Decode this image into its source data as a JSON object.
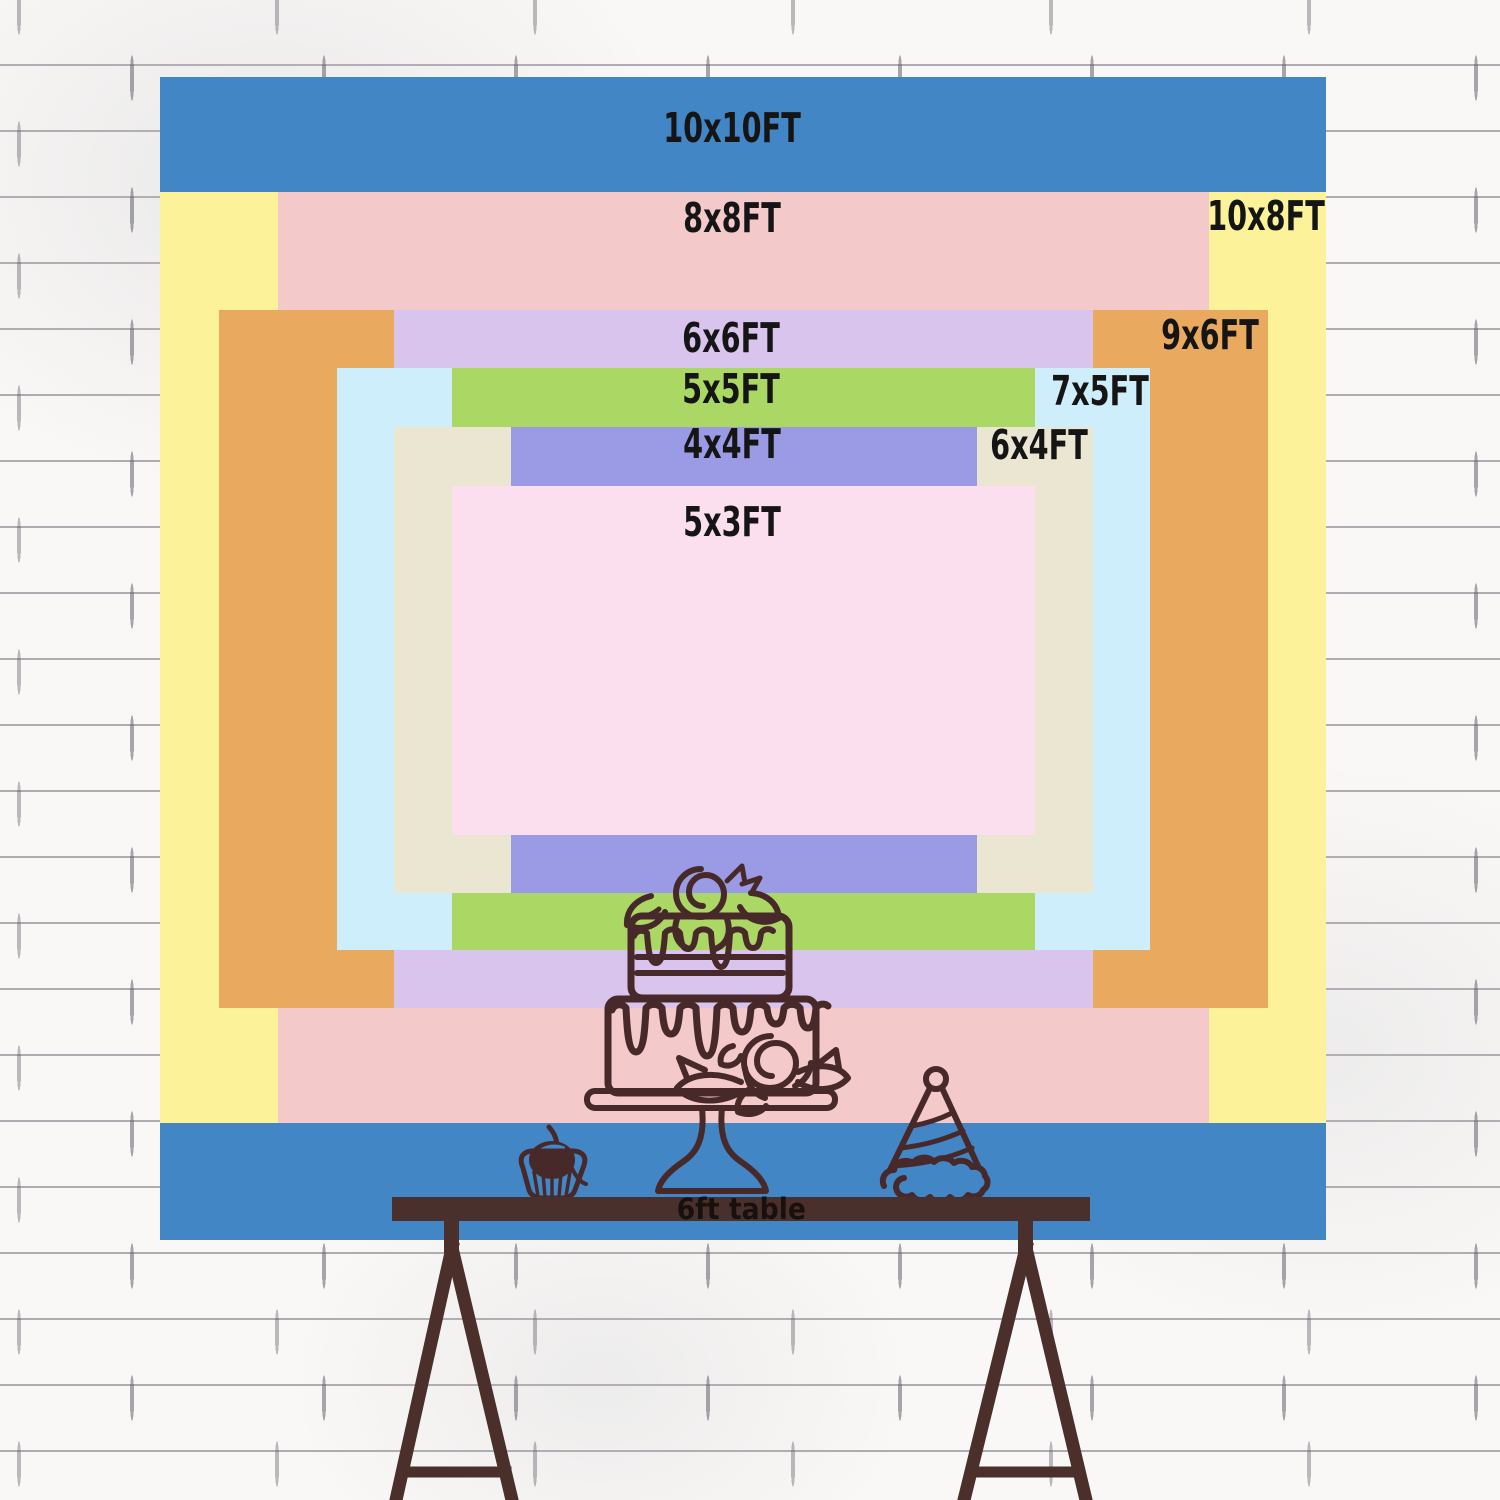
{
  "backdrop": {
    "title": "backdrop size comparison chart",
    "wall": {
      "background": "#f9f8f6",
      "mortar_line": "#64606a"
    },
    "label_text_color": "#151515",
    "illustration_stroke_color": "#48292a",
    "sizes": [
      {
        "label": "10x10FT",
        "width_ft": 10,
        "height_ft": 10,
        "x": 160,
        "y": 77,
        "w": 1166,
        "h": 1163,
        "color": "#4286c6",
        "label_x": 732,
        "label_y": 128
      },
      {
        "label": "10x8FT",
        "width_ft": 10,
        "height_ft": 8,
        "x": 160,
        "y": 192,
        "w": 1166,
        "h": 931,
        "color": "#fbf29a",
        "label_x": 1266,
        "label_y": 216
      },
      {
        "label": "8x8FT",
        "width_ft": 8,
        "height_ft": 8,
        "x": 278,
        "y": 192,
        "w": 931,
        "h": 931,
        "color": "#f3c9ca",
        "label_x": 732,
        "label_y": 218
      },
      {
        "label": "9x6FT",
        "width_ft": 9,
        "height_ft": 6,
        "x": 219,
        "y": 310,
        "w": 1049,
        "h": 698,
        "color": "#e9a95e",
        "label_x": 1210,
        "label_y": 335
      },
      {
        "label": "6x6FT",
        "width_ft": 6,
        "height_ft": 6,
        "x": 394,
        "y": 310,
        "w": 699,
        "h": 698,
        "color": "#d9c4ee",
        "label_x": 731,
        "label_y": 338
      },
      {
        "label": "7x5FT",
        "width_ft": 7,
        "height_ft": 5,
        "x": 337,
        "y": 368,
        "w": 813,
        "h": 582,
        "color": "#cdeefa",
        "label_x": 1100,
        "label_y": 391
      },
      {
        "label": "5x5FT",
        "width_ft": 5,
        "height_ft": 5,
        "x": 452,
        "y": 368,
        "w": 583,
        "h": 582,
        "color": "#abd765",
        "label_x": 731,
        "label_y": 389
      },
      {
        "label": "6x4FT",
        "width_ft": 6,
        "height_ft": 4,
        "x": 394,
        "y": 427,
        "w": 699,
        "h": 466,
        "color": "#ebe6d2",
        "label_x": 1039,
        "label_y": 445
      },
      {
        "label": "4x4FT",
        "width_ft": 4,
        "height_ft": 4,
        "x": 511,
        "y": 427,
        "w": 466,
        "h": 466,
        "color": "#9a9be4",
        "label_x": 732,
        "label_y": 444
      },
      {
        "label": "5x3FT",
        "width_ft": 5,
        "height_ft": 3,
        "x": 452,
        "y": 486,
        "w": 583,
        "h": 349,
        "color": "#fbdfee",
        "label_x": 732,
        "label_y": 522
      }
    ],
    "table": {
      "label": "6ft table",
      "x": 392,
      "y": 1197,
      "w": 698,
      "h": 24,
      "color": "#4a302d",
      "label_color": "#17100c"
    },
    "decorations": [
      "cake-icon",
      "cupcake-icon",
      "party-hat-icon"
    ]
  }
}
